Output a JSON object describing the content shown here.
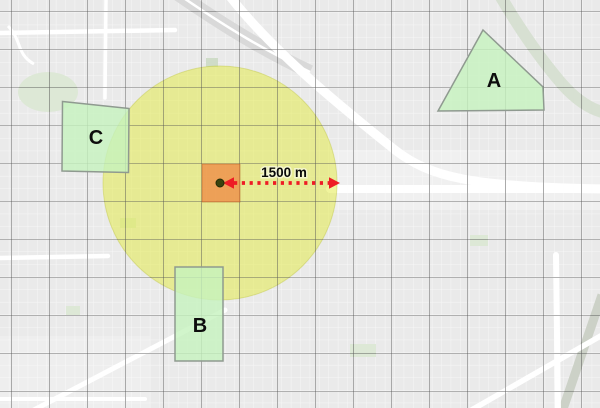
{
  "map": {
    "distance_label": "1500 m",
    "zones": {
      "a": "A",
      "b": "B",
      "c": "C"
    },
    "colors": {
      "buffer_fill": "rgba(226,233,60,0.5)",
      "buffer_stroke": "rgba(193,200,70,0.45)",
      "zone_fill": "rgba(198,243,190,0.8)",
      "zone_stroke": "#8f9a90",
      "center_cell_fill": "rgba(240,115,50,0.62)",
      "arrow_color": "#ee1c25",
      "center_dot_color": "#3a430e",
      "graticule_color": "#4a4a4a"
    }
  }
}
